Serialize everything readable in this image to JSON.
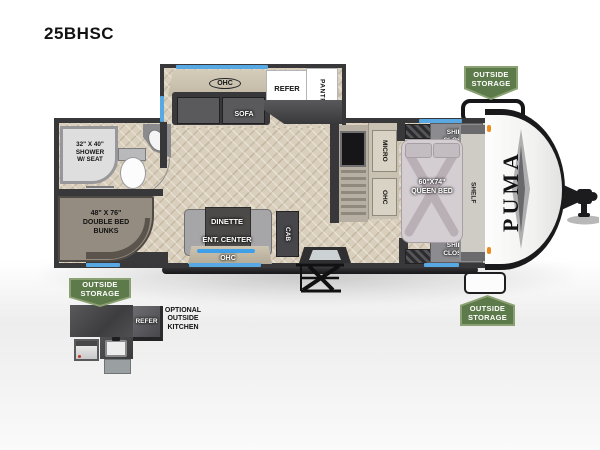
{
  "title": "25BHSC",
  "brand": "PUMA",
  "badges": {
    "front_top": {
      "line1": "OUTSIDE",
      "line2": "STORAGE"
    },
    "rear_bottom": {
      "line1": "OUTSIDE",
      "line2": "STORAGE"
    },
    "front_bottom": {
      "line1": "OUTSIDE",
      "line2": "STORAGE"
    }
  },
  "slideout": {
    "ohc": "OHC",
    "sofa": "SOFA",
    "refer": "REFER",
    "pantry": "PANTRY"
  },
  "kitchen": {
    "micro": "MICRO",
    "ohc": "OHC"
  },
  "bedroom": {
    "shirt_closet_top": {
      "line1": "SHIRT",
      "line2": "CLOSET"
    },
    "shirt_closet_bottom": {
      "line1": "SHIRT",
      "line2": "CLOSET"
    },
    "queen_bed": {
      "line1": "60\"X74\"",
      "line2": "QUEEN BED"
    },
    "shelf": "SHELF"
  },
  "bathroom": {
    "shower": {
      "line1": "32\" X 40\"",
      "line2": "SHOWER",
      "line3": "W/ SEAT"
    }
  },
  "bunks": {
    "line1": "48\" X 76\"",
    "line2": "DOUBLE BED",
    "line3": "BUNKS"
  },
  "living": {
    "dinette": "DINETTE",
    "ent_center": "ENT. CENTER",
    "ohc": "OHC",
    "cab": "CAB"
  },
  "outside_kitchen": {
    "refer": "REFER",
    "label": {
      "line1": "OPTIONAL",
      "line2": "OUTSIDE",
      "line3": "KITCHEN"
    }
  },
  "colors": {
    "badge_green": "#5d7a4a",
    "window_blue": "#58a8e4",
    "accent_blue": "#3f9fe8"
  }
}
